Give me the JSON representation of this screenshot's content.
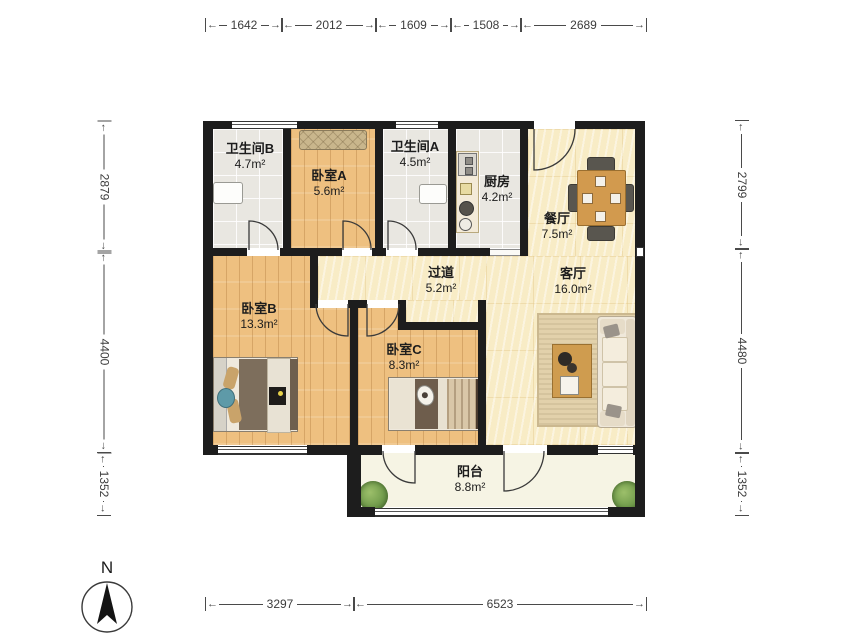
{
  "plan": {
    "type": "apartment-floor-plan",
    "compass": {
      "label": "N"
    }
  },
  "dimensions": {
    "top": [
      "1642",
      "2012",
      "1609",
      "1508",
      "2689"
    ],
    "bottom": [
      "3297",
      "6523"
    ],
    "left": [
      "2879",
      "4400",
      "1352"
    ],
    "right": [
      "2799",
      "4480",
      "1352"
    ]
  },
  "rooms": [
    {
      "id": "bathroom-b",
      "name": "卫生间B",
      "area": "4.7m²"
    },
    {
      "id": "bedroom-a",
      "name": "卧室A",
      "area": "5.6m²"
    },
    {
      "id": "bathroom-a",
      "name": "卫生间A",
      "area": "4.5m²"
    },
    {
      "id": "kitchen",
      "name": "厨房",
      "area": "4.2m²"
    },
    {
      "id": "dining",
      "name": "餐厅",
      "area": "7.5m²"
    },
    {
      "id": "hallway",
      "name": "过道",
      "area": "5.2m²"
    },
    {
      "id": "living",
      "name": "客厅",
      "area": "16.0m²"
    },
    {
      "id": "bedroom-b",
      "name": "卧室B",
      "area": "13.3m²"
    },
    {
      "id": "bedroom-c",
      "name": "卧室C",
      "area": "8.3m²"
    },
    {
      "id": "balcony",
      "name": "阳台",
      "area": "8.8m²"
    }
  ],
  "colors": {
    "wall": "#1d1d1d",
    "wood_floor": "#eec080",
    "cream_floor": "#f8ecc6",
    "tile_floor": "#e9e7e1",
    "balcony_floor": "#f6f4e4",
    "plant": "#6f9a4a",
    "dining_table": "#d29a4e"
  }
}
